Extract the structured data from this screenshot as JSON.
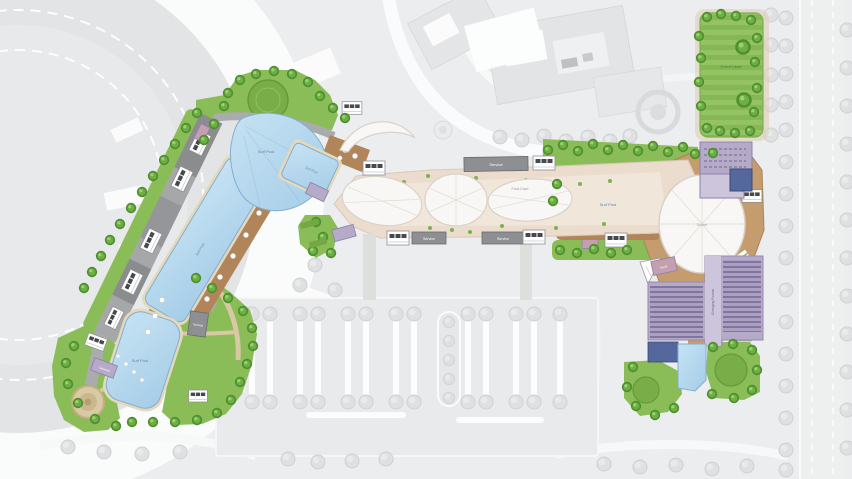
{
  "canvas": {
    "width": 852,
    "height": 479
  },
  "plan_type": "resort-waterpark-site-plan",
  "labels": {
    "surf_pool": "Surf Pool",
    "service": "Service",
    "event_lawn": "Event Lawn",
    "dome": "Dome",
    "changing_rooms": "Changing Rooms",
    "food_court": "Food Court",
    "kiosk": "Kiosk",
    "cabanas": "Cabanas"
  },
  "colors": {
    "background": "#ecedee",
    "context": "#e3e4e5",
    "context_white": "#fbfbfc",
    "road": "#f5f6f6",
    "pool": "#aed3eb",
    "pool_light": "#c6e2f3",
    "pool_stroke": "#84aecd",
    "pool_dark": "#54689e",
    "coping": "#e4d8bd",
    "lawn": "#8abd57",
    "lawn_dark": "#75a844",
    "tree": "#4f8f2f",
    "wood": "#b1845a",
    "wood_light": "#c59c6e",
    "plaza": "#ecdccd",
    "plaza_light": "#f5ece2",
    "canopy": "#f8f7f5",
    "canopy_stroke": "#d8d2c9",
    "purple": "#b5aac8",
    "purple_dark": "#8d81a8",
    "purple_light": "#cdc5dc",
    "pink": "#c49fb0",
    "service_gray": "#8d8f92",
    "band_gray": "#a6a7a9",
    "sand": "#d9c8a3",
    "context_tree": "#dfe0e1",
    "label_blue": "#64839f",
    "label_green": "#4e7a33",
    "label_purple": "#6f6590"
  }
}
